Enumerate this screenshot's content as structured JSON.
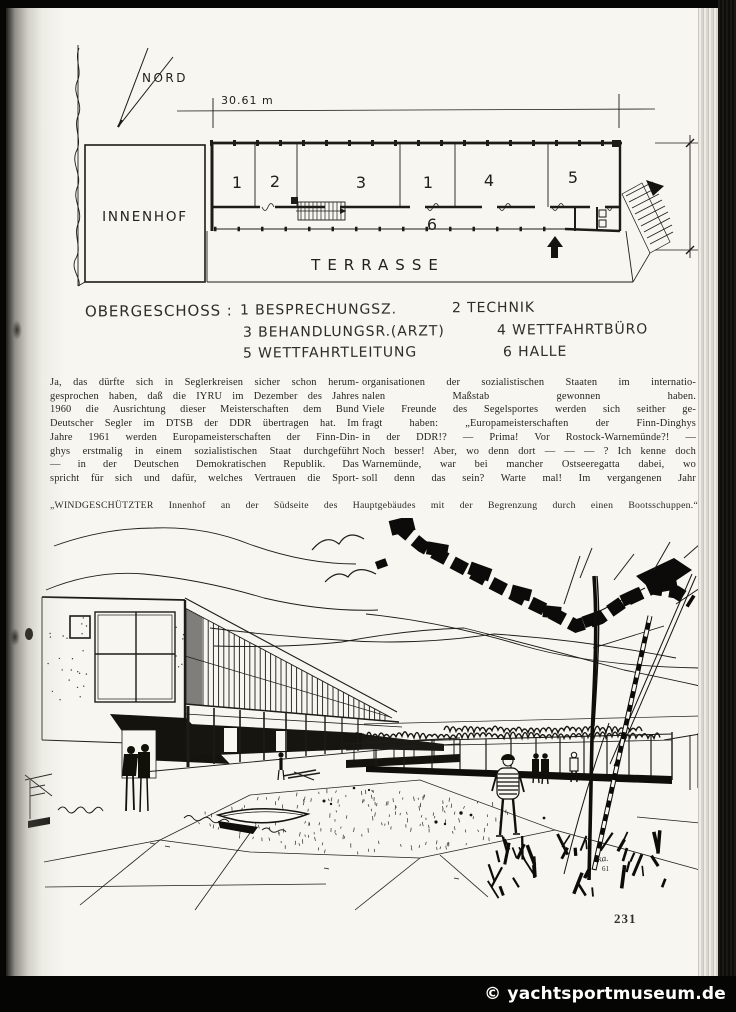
{
  "colors": {
    "page_bg": "#f7f6f0",
    "ink": "#1d1c19",
    "scan_black": "#060605",
    "watermark_bg": "#050504",
    "watermark_fg": "#ffffff"
  },
  "plan": {
    "north": "NORD",
    "dim_width": "30.61 m",
    "dim_height": "7.90",
    "innenhof": "INNENHOF",
    "terrasse": "TERRASSE",
    "rooms": {
      "r1a": "1",
      "r2": "2",
      "r3": "3",
      "r1b": "1",
      "r4": "4",
      "r5": "5",
      "hall": "6"
    }
  },
  "legend": {
    "title": "OBERGESCHOSS :",
    "item1": "1  BESPRECHUNGSZ.",
    "item2": "2 TECHNIK",
    "item3": "3  BEHANDLUNGSR.(ARZT)",
    "item4": "4 WETTFAHRTBÜRO",
    "item5": "5  WETTFAHRTLEITUNG",
    "item6": "6 HALLE"
  },
  "article": {
    "col_left": "Ja, das dürfte sich in Seglerkreisen sicher schon herum-\ngesprochen haben, daß die IYRU im Dezember des Jahres\n1960 die Ausrichtung dieser Meisterschaften dem Bund\nDeutscher Segler im DTSB der DDR übertragen hat. Im\nJahre 1961 werden Europameisterschaften der Finn-Din-\nghys erstmalig in einem sozialistischen Staat durchgeführt\n— in der Deutschen Demokratischen Republik. Das\nspricht für sich und dafür, welches Vertrauen die Sport-",
    "col_right": "organisationen der sozialistischen Staaten im internatio-\nnalen Maßstab gewonnen haben.\nViele Freunde des Segelsportes werden sich seither ge-\nfragt haben: „Europameisterschaften der Finn-Dinghys\nin der DDR!? — Prima! Vor Rostock-Warnemünde?! —\nNoch besser! Aber, wo denn dort — — — ? Ich kenne doch\nWarnemünde, war bei mancher Ostseeregatta dabei, wo\nsoll denn das sein? Warte mal! Im vergangenen Jahr",
    "caption": "„WINDGESCHÜTZTER Innenhof an der Südseite des Hauptgebäudes mit der Begrenzung durch einen Bootsschuppen.“"
  },
  "sketch": {
    "signature_line1": "ka.",
    "signature_line2": "61"
  },
  "page": {
    "number": "231"
  },
  "watermark": "© yachtsportmuseum.de"
}
